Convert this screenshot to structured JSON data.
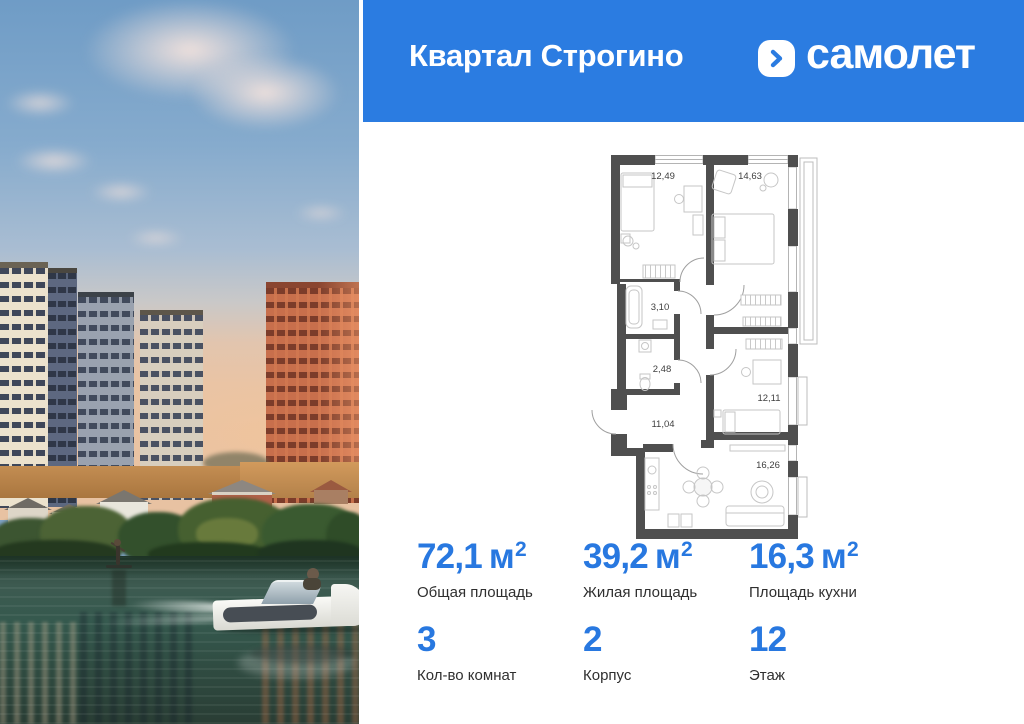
{
  "theme": {
    "accent_blue": "#2b7ce1",
    "stat_blue": "#2878e0",
    "wall_color": "#4f4f4f",
    "label_color": "#2f2f2f"
  },
  "header": {
    "project_title": "Квартал Строгино",
    "brand_name": "самолет"
  },
  "floor_plan": {
    "rooms": [
      {
        "id": "bedroom-1",
        "area": "12,49"
      },
      {
        "id": "bedroom-2",
        "area": "14,63"
      },
      {
        "id": "bathroom",
        "area": "3,10"
      },
      {
        "id": "wc",
        "area": "2,48"
      },
      {
        "id": "hallway",
        "area": "11,04"
      },
      {
        "id": "bedroom-3",
        "area": "12,11"
      },
      {
        "id": "kitchen-living",
        "area": "16,26"
      }
    ]
  },
  "stats": {
    "cells": [
      {
        "value": "72,1",
        "unit": "м",
        "unit_sup": "2",
        "label": "Общая площадь"
      },
      {
        "value": "39,2",
        "unit": "м",
        "unit_sup": "2",
        "label": "Жилая площадь"
      },
      {
        "value": "16,3",
        "unit": "м",
        "unit_sup": "2",
        "label": "Площадь кухни"
      },
      {
        "value": "3",
        "label": "Кол-во комнат"
      },
      {
        "value": "2",
        "label": "Корпус"
      },
      {
        "value": "12",
        "label": "Этаж"
      }
    ]
  }
}
